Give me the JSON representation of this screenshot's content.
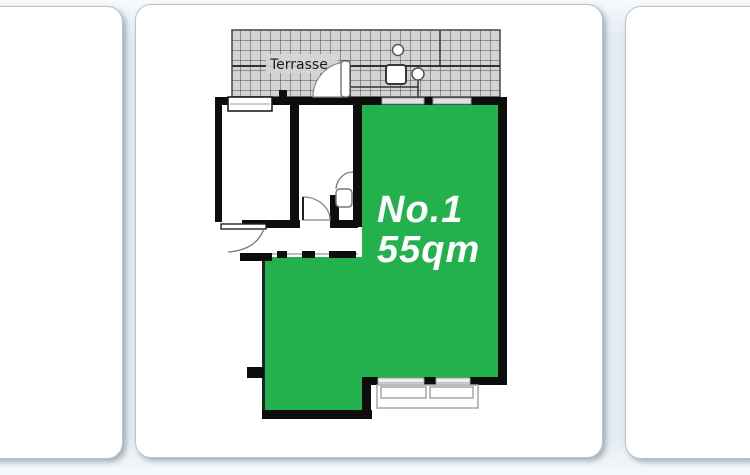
{
  "floorplan": {
    "terrace": {
      "label": "Terrasse"
    },
    "unit": {
      "number": "No.1",
      "area": "55qm"
    },
    "colors": {
      "unit_highlight": "#22b14c",
      "unit_text": "#ffffff",
      "wall": "#0d0d0d",
      "terrace_fill": "#d3d3d3"
    }
  }
}
